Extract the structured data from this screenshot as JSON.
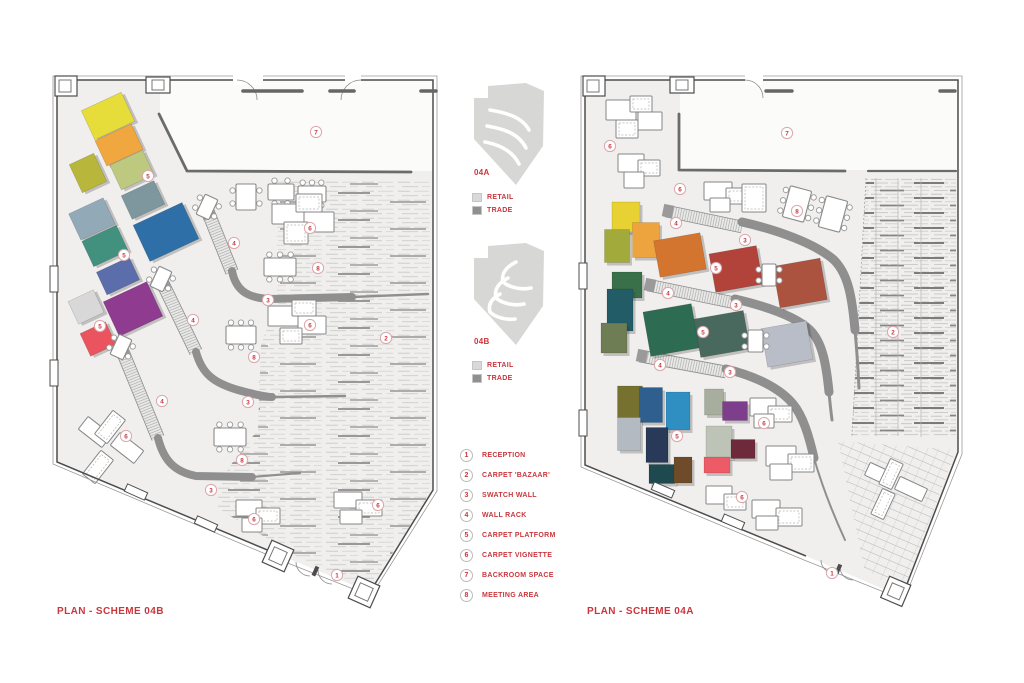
{
  "page": {
    "background": "#ffffff",
    "accent_red": "#c9373d"
  },
  "plans": {
    "left": {
      "title": "PLAN - SCHEME 04B",
      "balloons": [
        {
          "n": "7",
          "x": 316,
          "y": 132
        },
        {
          "n": "5",
          "x": 148,
          "y": 176
        },
        {
          "n": "4",
          "x": 234,
          "y": 243
        },
        {
          "n": "6",
          "x": 310,
          "y": 228
        },
        {
          "n": "8",
          "x": 318,
          "y": 268
        },
        {
          "n": "3",
          "x": 268,
          "y": 300
        },
        {
          "n": "5",
          "x": 124,
          "y": 255
        },
        {
          "n": "4",
          "x": 193,
          "y": 320
        },
        {
          "n": "6",
          "x": 310,
          "y": 325
        },
        {
          "n": "2",
          "x": 386,
          "y": 338
        },
        {
          "n": "8",
          "x": 254,
          "y": 357
        },
        {
          "n": "5",
          "x": 100,
          "y": 326
        },
        {
          "n": "3",
          "x": 248,
          "y": 402
        },
        {
          "n": "4",
          "x": 162,
          "y": 401
        },
        {
          "n": "8",
          "x": 242,
          "y": 460
        },
        {
          "n": "6",
          "x": 126,
          "y": 436
        },
        {
          "n": "3",
          "x": 211,
          "y": 490
        },
        {
          "n": "6",
          "x": 254,
          "y": 519
        },
        {
          "n": "6",
          "x": 378,
          "y": 505
        },
        {
          "n": "1",
          "x": 337,
          "y": 575
        }
      ],
      "carpets": [
        {
          "x": 108,
          "y": 116,
          "w": 44,
          "h": 32,
          "r": -25,
          "c": "#e6dd3a"
        },
        {
          "x": 119,
          "y": 145,
          "w": 40,
          "h": 28,
          "r": -25,
          "c": "#f1a73f"
        },
        {
          "x": 88,
          "y": 173,
          "w": 27,
          "h": 31,
          "r": -25,
          "c": "#b8b73b"
        },
        {
          "x": 132,
          "y": 170,
          "w": 36,
          "h": 27,
          "r": -25,
          "c": "#bcc97f"
        },
        {
          "x": 143,
          "y": 200,
          "w": 36,
          "h": 26,
          "r": -25,
          "c": "#7e969d"
        },
        {
          "x": 166,
          "y": 232,
          "w": 54,
          "h": 40,
          "r": -25,
          "c": "#2f6fa7"
        },
        {
          "x": 92,
          "y": 219,
          "w": 38,
          "h": 29,
          "r": -25,
          "c": "#92a9b8"
        },
        {
          "x": 105,
          "y": 246,
          "w": 38,
          "h": 28,
          "r": -25,
          "c": "#42907e"
        },
        {
          "x": 118,
          "y": 276,
          "w": 36,
          "h": 25,
          "r": -25,
          "c": "#5b6daa"
        },
        {
          "x": 133,
          "y": 309,
          "w": 48,
          "h": 38,
          "r": -25,
          "c": "#8e3b90"
        },
        {
          "x": 86,
          "y": 307,
          "w": 28,
          "h": 25,
          "r": -25,
          "c": "#d8d8d8"
        },
        {
          "x": 98,
          "y": 339,
          "w": 28,
          "h": 25,
          "r": -25,
          "c": "#e9545e"
        }
      ]
    },
    "right": {
      "title": "PLAN - SCHEME 04A",
      "balloons": [
        {
          "n": "7",
          "x": 787,
          "y": 133
        },
        {
          "n": "6",
          "x": 610,
          "y": 146
        },
        {
          "n": "6",
          "x": 680,
          "y": 189
        },
        {
          "n": "8",
          "x": 797,
          "y": 211
        },
        {
          "n": "4",
          "x": 676,
          "y": 223
        },
        {
          "n": "3",
          "x": 745,
          "y": 240
        },
        {
          "n": "5",
          "x": 716,
          "y": 268
        },
        {
          "n": "4",
          "x": 668,
          "y": 293
        },
        {
          "n": "3",
          "x": 736,
          "y": 305
        },
        {
          "n": "5",
          "x": 703,
          "y": 332
        },
        {
          "n": "2",
          "x": 893,
          "y": 332
        },
        {
          "n": "4",
          "x": 660,
          "y": 365
        },
        {
          "n": "3",
          "x": 730,
          "y": 372
        },
        {
          "n": "5",
          "x": 677,
          "y": 436
        },
        {
          "n": "6",
          "x": 764,
          "y": 423
        },
        {
          "n": "6",
          "x": 742,
          "y": 497
        },
        {
          "n": "1",
          "x": 832,
          "y": 573
        }
      ],
      "carpets": [
        {
          "x": 626,
          "y": 217,
          "w": 28,
          "h": 30,
          "r": 0,
          "c": "#e8d233"
        },
        {
          "x": 646,
          "y": 240,
          "w": 27,
          "h": 35,
          "r": 0,
          "c": "#eda43e"
        },
        {
          "x": 617,
          "y": 246,
          "w": 25,
          "h": 33,
          "r": 0,
          "c": "#a2aa3c"
        },
        {
          "x": 627,
          "y": 285,
          "w": 30,
          "h": 26,
          "r": 0,
          "c": "#3a7049"
        },
        {
          "x": 620,
          "y": 310,
          "w": 26,
          "h": 42,
          "r": 0,
          "c": "#215c67"
        },
        {
          "x": 614,
          "y": 338,
          "w": 26,
          "h": 30,
          "r": 0,
          "c": "#6e7d53"
        },
        {
          "x": 680,
          "y": 255,
          "w": 47,
          "h": 37,
          "r": -10,
          "c": "#d3742f"
        },
        {
          "x": 736,
          "y": 269,
          "w": 48,
          "h": 39,
          "r": -10,
          "c": "#b2433a"
        },
        {
          "x": 800,
          "y": 283,
          "w": 48,
          "h": 42,
          "r": -10,
          "c": "#ac5340"
        },
        {
          "x": 671,
          "y": 330,
          "w": 49,
          "h": 45,
          "r": -10,
          "c": "#2d6b52"
        },
        {
          "x": 722,
          "y": 334,
          "w": 50,
          "h": 39,
          "r": -10,
          "c": "#4a695e"
        },
        {
          "x": 787,
          "y": 344,
          "w": 46,
          "h": 39,
          "r": -10,
          "c": "#b9bdc8"
        },
        {
          "x": 630,
          "y": 402,
          "w": 25,
          "h": 32,
          "r": 0,
          "c": "#76712f"
        },
        {
          "x": 651,
          "y": 405,
          "w": 23,
          "h": 35,
          "r": 0,
          "c": "#2e5f8f"
        },
        {
          "x": 678,
          "y": 411,
          "w": 24,
          "h": 38,
          "r": 0,
          "c": "#2f8fc3"
        },
        {
          "x": 629,
          "y": 434,
          "w": 23,
          "h": 33,
          "r": 0,
          "c": "#b4bac1"
        },
        {
          "x": 657,
          "y": 445,
          "w": 22,
          "h": 35,
          "r": 0,
          "c": "#283a57"
        },
        {
          "x": 662,
          "y": 474,
          "w": 26,
          "h": 19,
          "r": 0,
          "c": "#1e4a4f"
        },
        {
          "x": 683,
          "y": 470,
          "w": 18,
          "h": 26,
          "r": 0,
          "c": "#6f4c29"
        },
        {
          "x": 714,
          "y": 402,
          "w": 19,
          "h": 26,
          "r": 0,
          "c": "#a7ae9e"
        },
        {
          "x": 735,
          "y": 411,
          "w": 25,
          "h": 19,
          "r": 0,
          "c": "#7d3e8b"
        },
        {
          "x": 719,
          "y": 442,
          "w": 26,
          "h": 32,
          "r": 0,
          "c": "#bdc4b7"
        },
        {
          "x": 743,
          "y": 449,
          "w": 24,
          "h": 19,
          "r": 0,
          "c": "#6e2a3a"
        },
        {
          "x": 717,
          "y": 465,
          "w": 26,
          "h": 16,
          "r": 0,
          "c": "#ec5b66"
        }
      ]
    }
  },
  "mini_plans": [
    {
      "id": "04A",
      "legend": [
        {
          "label": "RETAIL",
          "color": "#d9d9d9"
        },
        {
          "label": "TRADE",
          "color": "#8f8f8f"
        }
      ]
    },
    {
      "id": "04B",
      "legend": [
        {
          "label": "RETAIL",
          "color": "#d9d9d9"
        },
        {
          "label": "TRADE",
          "color": "#8f8f8f"
        }
      ]
    }
  ],
  "key": {
    "items": [
      {
        "num": "1",
        "label": "RECEPTION"
      },
      {
        "num": "2",
        "label": "CARPET 'BAZAAR'"
      },
      {
        "num": "3",
        "label": "SWATCH WALL"
      },
      {
        "num": "4",
        "label": "WALL RACK"
      },
      {
        "num": "5",
        "label": "CARPET PLATFORM"
      },
      {
        "num": "6",
        "label": "CARPET VIGNETTE"
      },
      {
        "num": "7",
        "label": "BACKROOM SPACE"
      },
      {
        "num": "8",
        "label": "MEETING AREA"
      }
    ]
  }
}
